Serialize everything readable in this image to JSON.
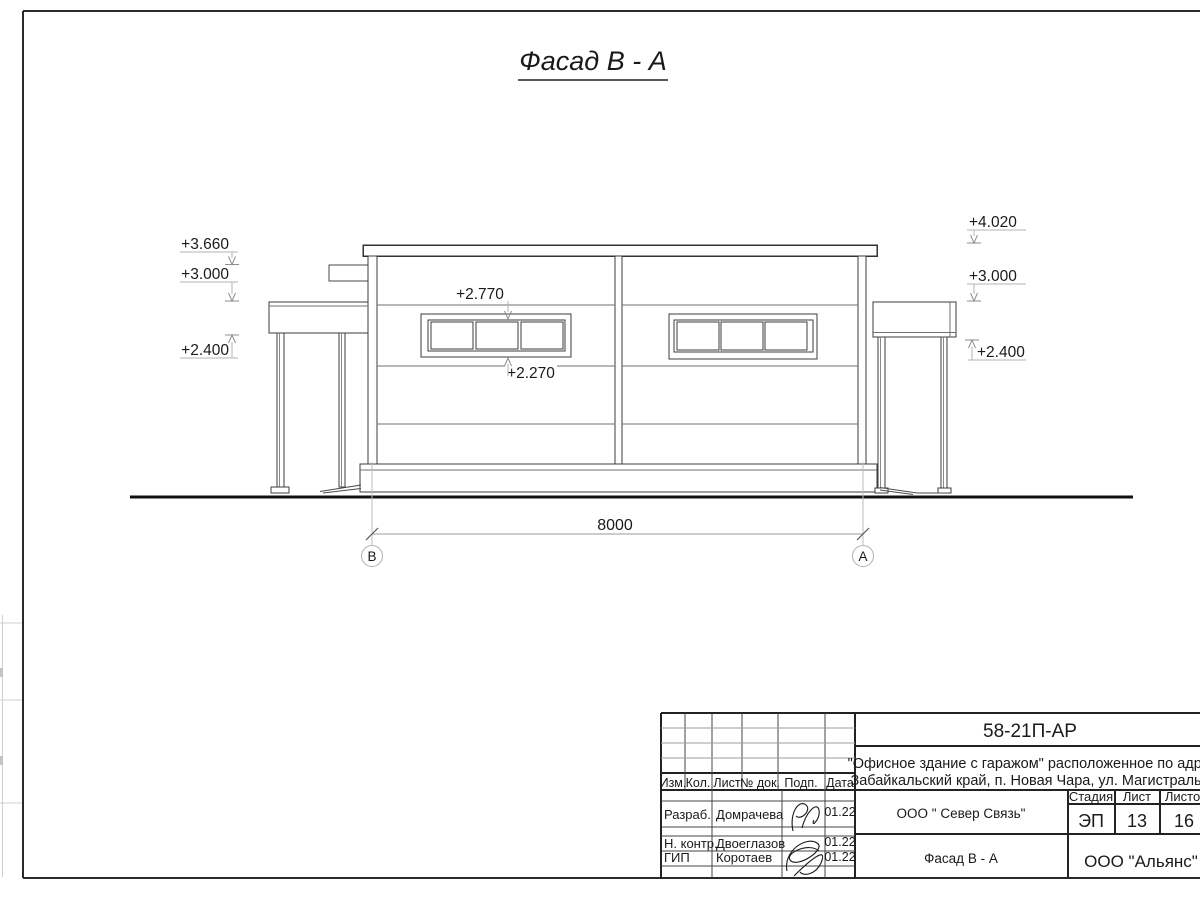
{
  "sheet": {
    "title": "Фасад В - А"
  },
  "facade": {
    "marks_left": [
      "+3.660",
      "+3.000",
      "+2.400"
    ],
    "marks_right": [
      "+4.020",
      "+3.000",
      "+2.400"
    ],
    "window_mark_top": "+2.770",
    "window_mark_bottom": "+2.270",
    "dim_width": "8000",
    "axis_left": "В",
    "axis_right": "А"
  },
  "stamp": {
    "doc_number": "58-21П-АР",
    "object_line1": "\"Офисное здание с гаражом\" расположенное по адресу:",
    "object_line2": "Забайкальский край, п. Новая Чара, ул. Магистральная",
    "col_izm": "Изм.",
    "col_kol": "Кол.",
    "col_list": "Лист",
    "col_doc": "№ док.",
    "col_podp": "Подп.",
    "col_data": "Дата",
    "row1_role": "Разраб.",
    "row1_name": "Домрачева",
    "row1_date": "01.22",
    "row2_role": "Н. контр.",
    "row2_name": "Двоеглазов",
    "row2_date": "01.22",
    "row3_role": "ГИП",
    "row3_name": "Коротаев",
    "row3_date": "01.22",
    "contractor": "ООО \" Север Связь\"",
    "sheet_name": "Фасад В - А",
    "stage_label": "Стадия",
    "list_label": "Лист",
    "listov_label": "Листов",
    "stage": "ЭП",
    "list": "13",
    "listov": "16",
    "org": "ООО \"Альянс\"",
    "line_color": "#1a1a1a"
  }
}
